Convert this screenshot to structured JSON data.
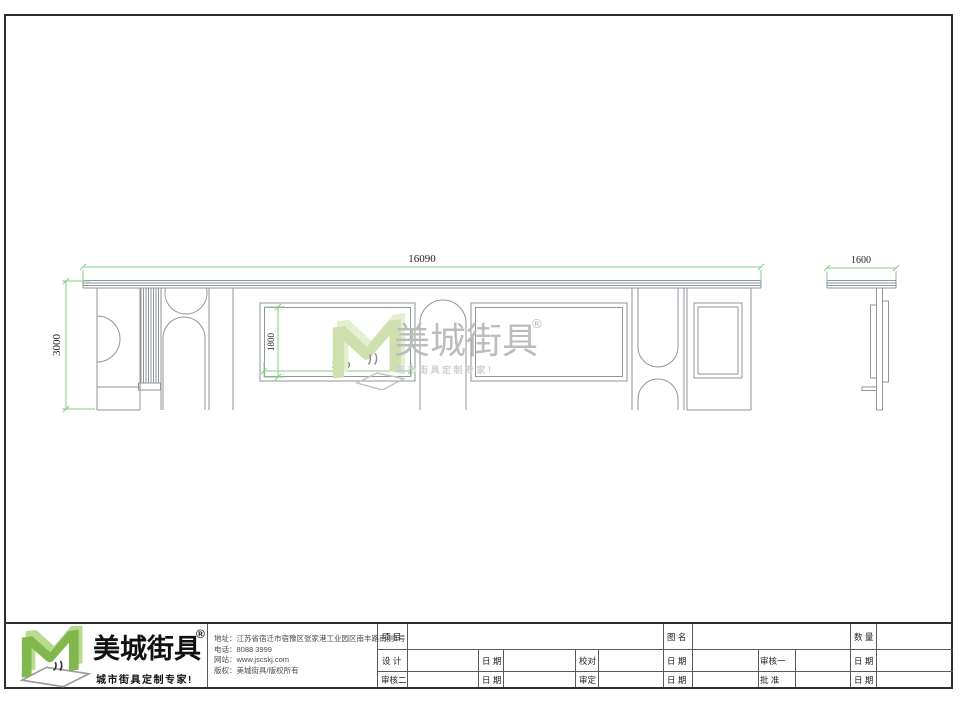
{
  "drawing": {
    "dim_front_width": "16090",
    "dim_front_height": "3000",
    "dim_panel_height": "1800",
    "dim_panel_width": "3660",
    "dim_side_width": "1600"
  },
  "watermark": {
    "brand": "美城街具",
    "registered": "®",
    "slogan": "城市街具定制专家!"
  },
  "footer": {
    "logo": {
      "brand": "美城街具",
      "registered": "®",
      "slogan": "城市街具定制专家!"
    },
    "company": {
      "lines": [
        "地址：江苏省宿迁市宿豫区张家港工业园区南丰路南侧1号",
        "电话：8088 3999",
        "网站：www.jscskj.com",
        "版权：美城街具/版权所有"
      ]
    },
    "table": {
      "project": "项 目",
      "drawing_name": "图 名",
      "quantity": "数 量",
      "design": "设 计",
      "proofread": "校对",
      "review1": "审核一",
      "review2": "审核二",
      "approve": "审定",
      "ratify": "批 准",
      "date": "日 期"
    }
  },
  "colors": {
    "brand_green": "#7cb648",
    "brand_green_light": "#b9db8e",
    "watermark_green": "#d3e4b5",
    "dim_green": "#85cc85",
    "line_gray": "#8f969b"
  }
}
